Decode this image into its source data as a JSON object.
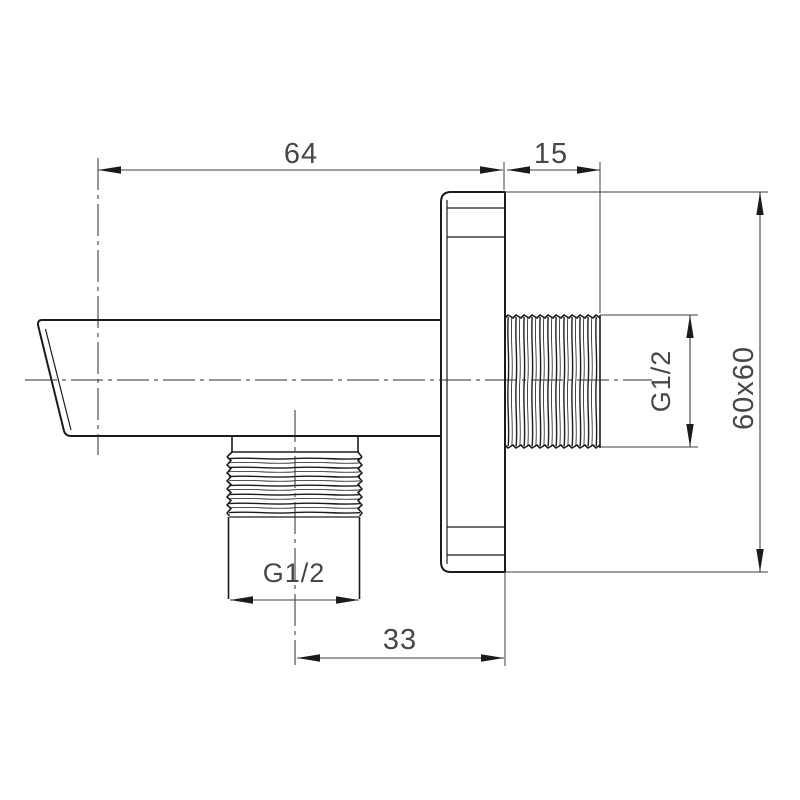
{
  "drawing": {
    "background_color": "#ffffff",
    "line_color": "#1b1b1b",
    "dimension_color": "#474747"
  },
  "dims": {
    "spout_length": "64",
    "wall_thread_depth": "15",
    "wall_thread_size": "G1/2",
    "plate_size": "60x60",
    "outlet_thread_size": "G1/2",
    "outlet_offset": "33"
  }
}
